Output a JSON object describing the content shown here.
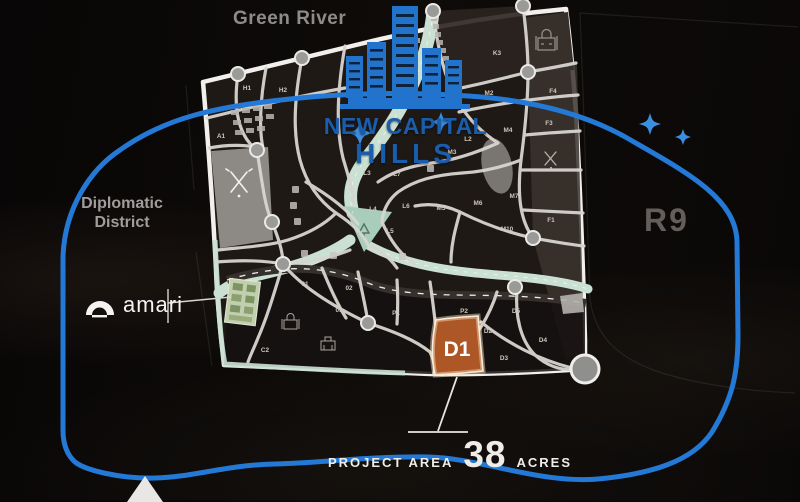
{
  "brand": {
    "line1": "NEW CAPITAL",
    "line2": "HILLS"
  },
  "regions": {
    "green_river": "Green River",
    "diplomatic_line1": "Diplomatic",
    "diplomatic_line2": "District",
    "r9": "R9"
  },
  "partner": {
    "name": "amari"
  },
  "highlight": {
    "plot": "D1"
  },
  "footer": {
    "label": "PROJECT AREA",
    "value": "38",
    "unit": "ACRES"
  },
  "map": {
    "plots": [
      "H1",
      "H2",
      "A1",
      "K3",
      "M2",
      "F4",
      "F3",
      "M4",
      "M3",
      "L2",
      "L3",
      "L7",
      "L4",
      "L6",
      "M5",
      "M6",
      "M7",
      "L5",
      "M10",
      "F1",
      "01",
      "02",
      "03",
      "P1",
      "P2",
      "D5",
      "D2",
      "D4",
      "D3",
      "C2"
    ]
  },
  "icons": {
    "logo_buildings": "skyline-buildings-icon",
    "amari_arch": "arch-icon",
    "golf": "golf-clubs-icon",
    "mosque": "mosque-icon",
    "school": "school-icon",
    "sparkle": "sparkle-icon",
    "pyramid": "pyramid-icon"
  },
  "colors": {
    "accent_blue": "#2379d5",
    "logo_blue": "#1a5dad",
    "highlight_orange": "#ad5626",
    "mint_road": "#c9e0d2",
    "road": "#d8d5d1"
  }
}
